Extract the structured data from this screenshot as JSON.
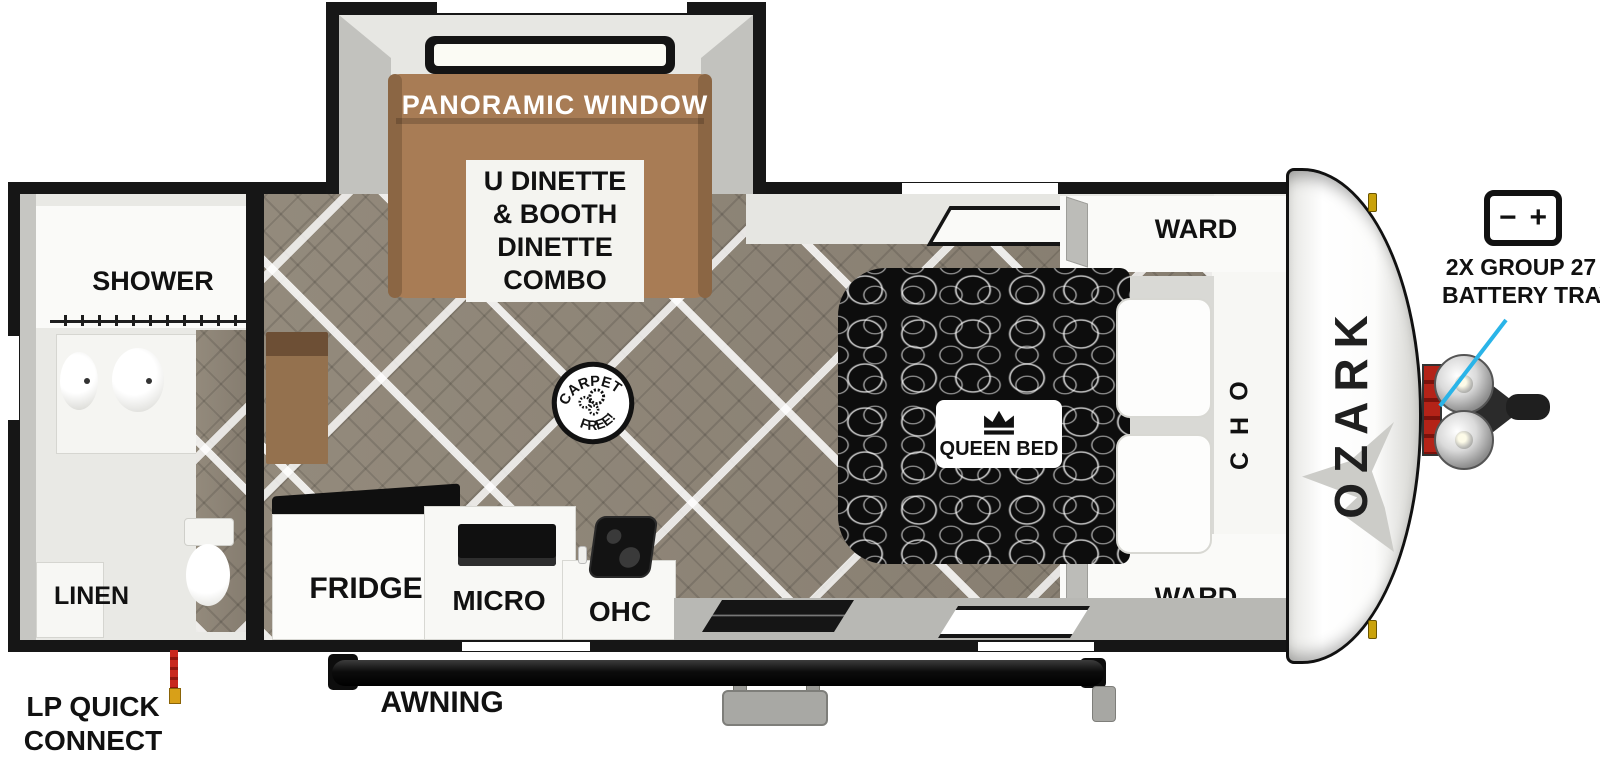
{
  "colors": {
    "accent_cyan": "#2AB4E8",
    "dinette_brown": "#A87C55",
    "floor_wood": "#8E8678",
    "bed_black": "#0D0D0D",
    "lp_red": "#C8281E",
    "lp_tip_yellow": "#D8A018",
    "clearance_amber": "#CAA20A"
  },
  "slideout": {
    "window_label": "PANORAMIC WINDOW",
    "dinette_lines": [
      "U DINETTE",
      "& BOOTH",
      "DINETTE",
      "COMBO"
    ]
  },
  "bathroom": {
    "shower_label": "SHOWER",
    "linen_label": "LINEN"
  },
  "living": {
    "carpet_badge_top": "CARPET",
    "carpet_badge_bottom": "FREE!"
  },
  "kitchen": {
    "fridge_label": "FRIDGE",
    "micro_label": "MICRO",
    "ohc_label": "OHC"
  },
  "bedroom": {
    "bed_label": "QUEEN BED",
    "ward_top_label": "WARD",
    "ward_bottom_label": "WARD",
    "ohc_letters": [
      "O",
      "H",
      "C"
    ]
  },
  "front_cap": {
    "brand": "OZARK"
  },
  "battery": {
    "minus": "−",
    "plus": "+",
    "line1": "2X GROUP 27",
    "line2": "BATTERY TRAY"
  },
  "exterior": {
    "awning_label": "AWNING",
    "lp_label": "LP QUICK CONNECT"
  }
}
